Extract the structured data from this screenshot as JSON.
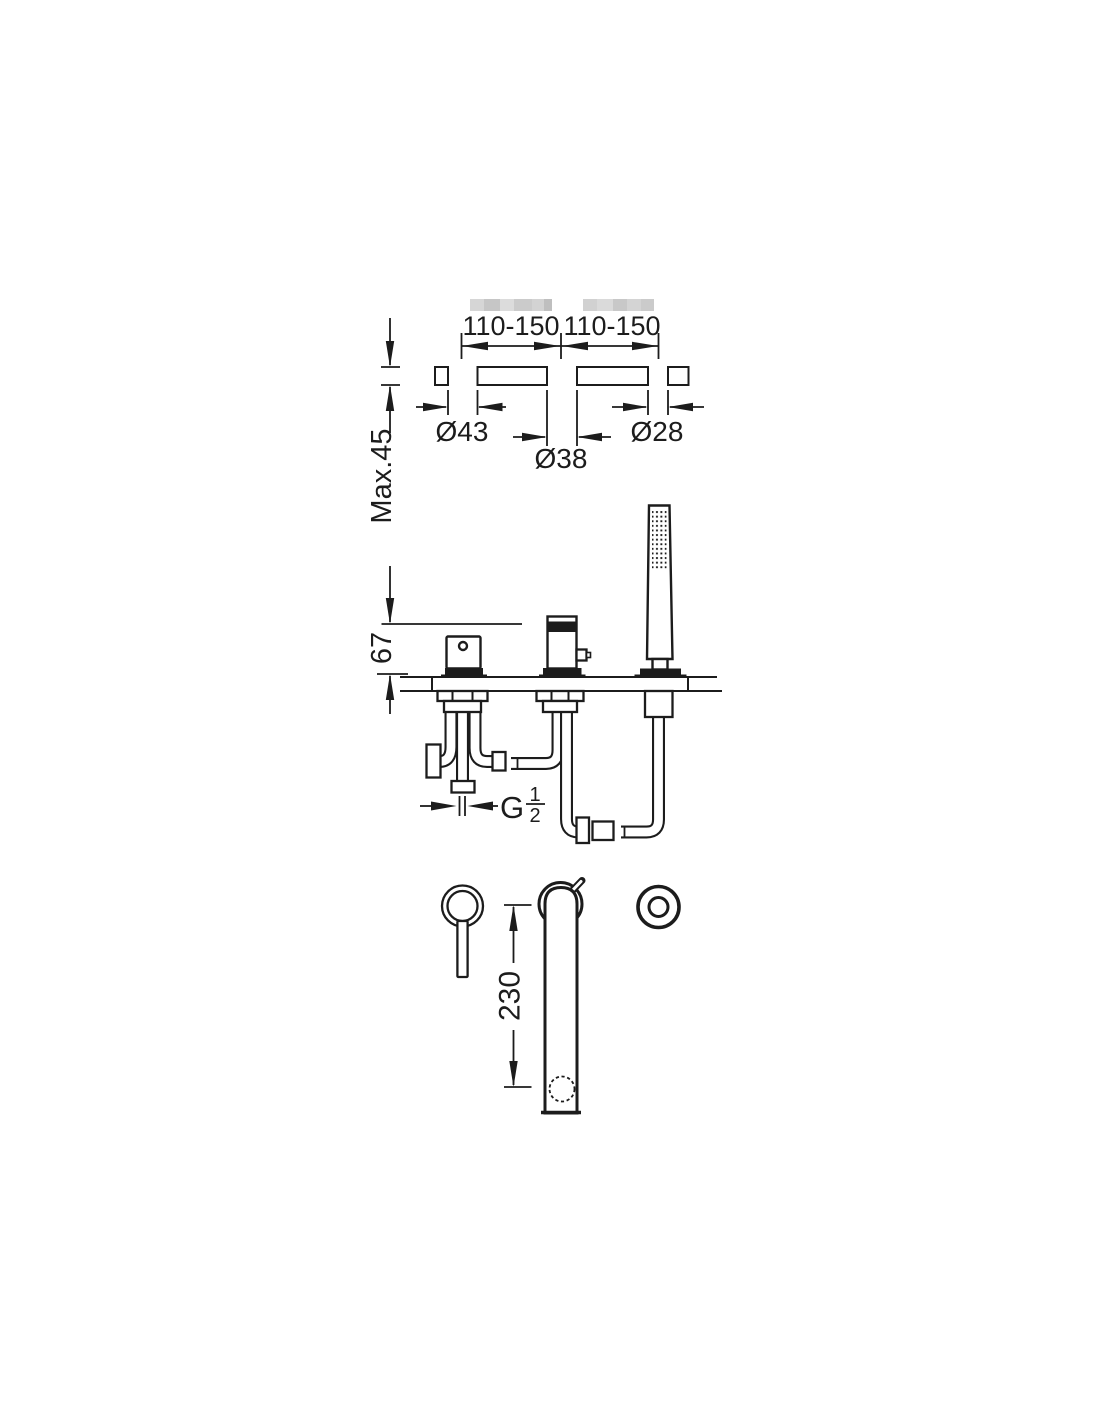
{
  "drawing": {
    "type": "bath-deck-mixer-installation-diagram",
    "colors": {
      "line": "#1c1c1c",
      "background": "#ffffff",
      "watermark_gray": "#c8c8c8"
    },
    "top_cross_section": {
      "spacing_left": "110-150",
      "spacing_right": "110-150",
      "hole_diameters": [
        "Ø43",
        "Ø38",
        "Ø28"
      ],
      "deck_thickness": "Max.45"
    },
    "side_elevation": {
      "height_above_deck": "67",
      "thread": {
        "letter": "G",
        "numerator": "1",
        "denominator": "2"
      }
    },
    "front_elevation": {
      "spout_length": "230"
    }
  }
}
